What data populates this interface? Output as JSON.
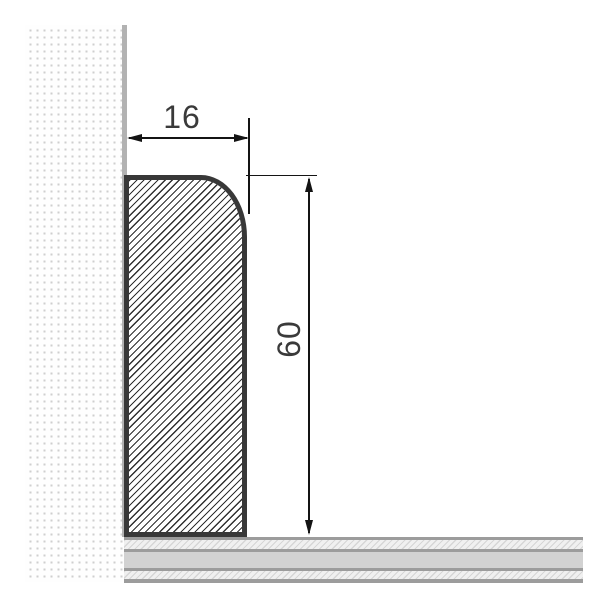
{
  "drawing": {
    "dimensions": {
      "width_label": "16",
      "height_label": "60"
    },
    "colors": {
      "background": "#ffffff",
      "profile_outline": "#383838",
      "hatch_line": "#2f2f2f",
      "dimension_ink": "#141414",
      "label_ink": "#3a3a3a",
      "wall_dot": "#cfcfcf",
      "wall_edge_line": "#b2b2b2",
      "floor_band_solid": "#d2d2d2",
      "floor_band_hatch_bg": "#f0f0f0",
      "floor_line": "#9c9c9c"
    }
  }
}
